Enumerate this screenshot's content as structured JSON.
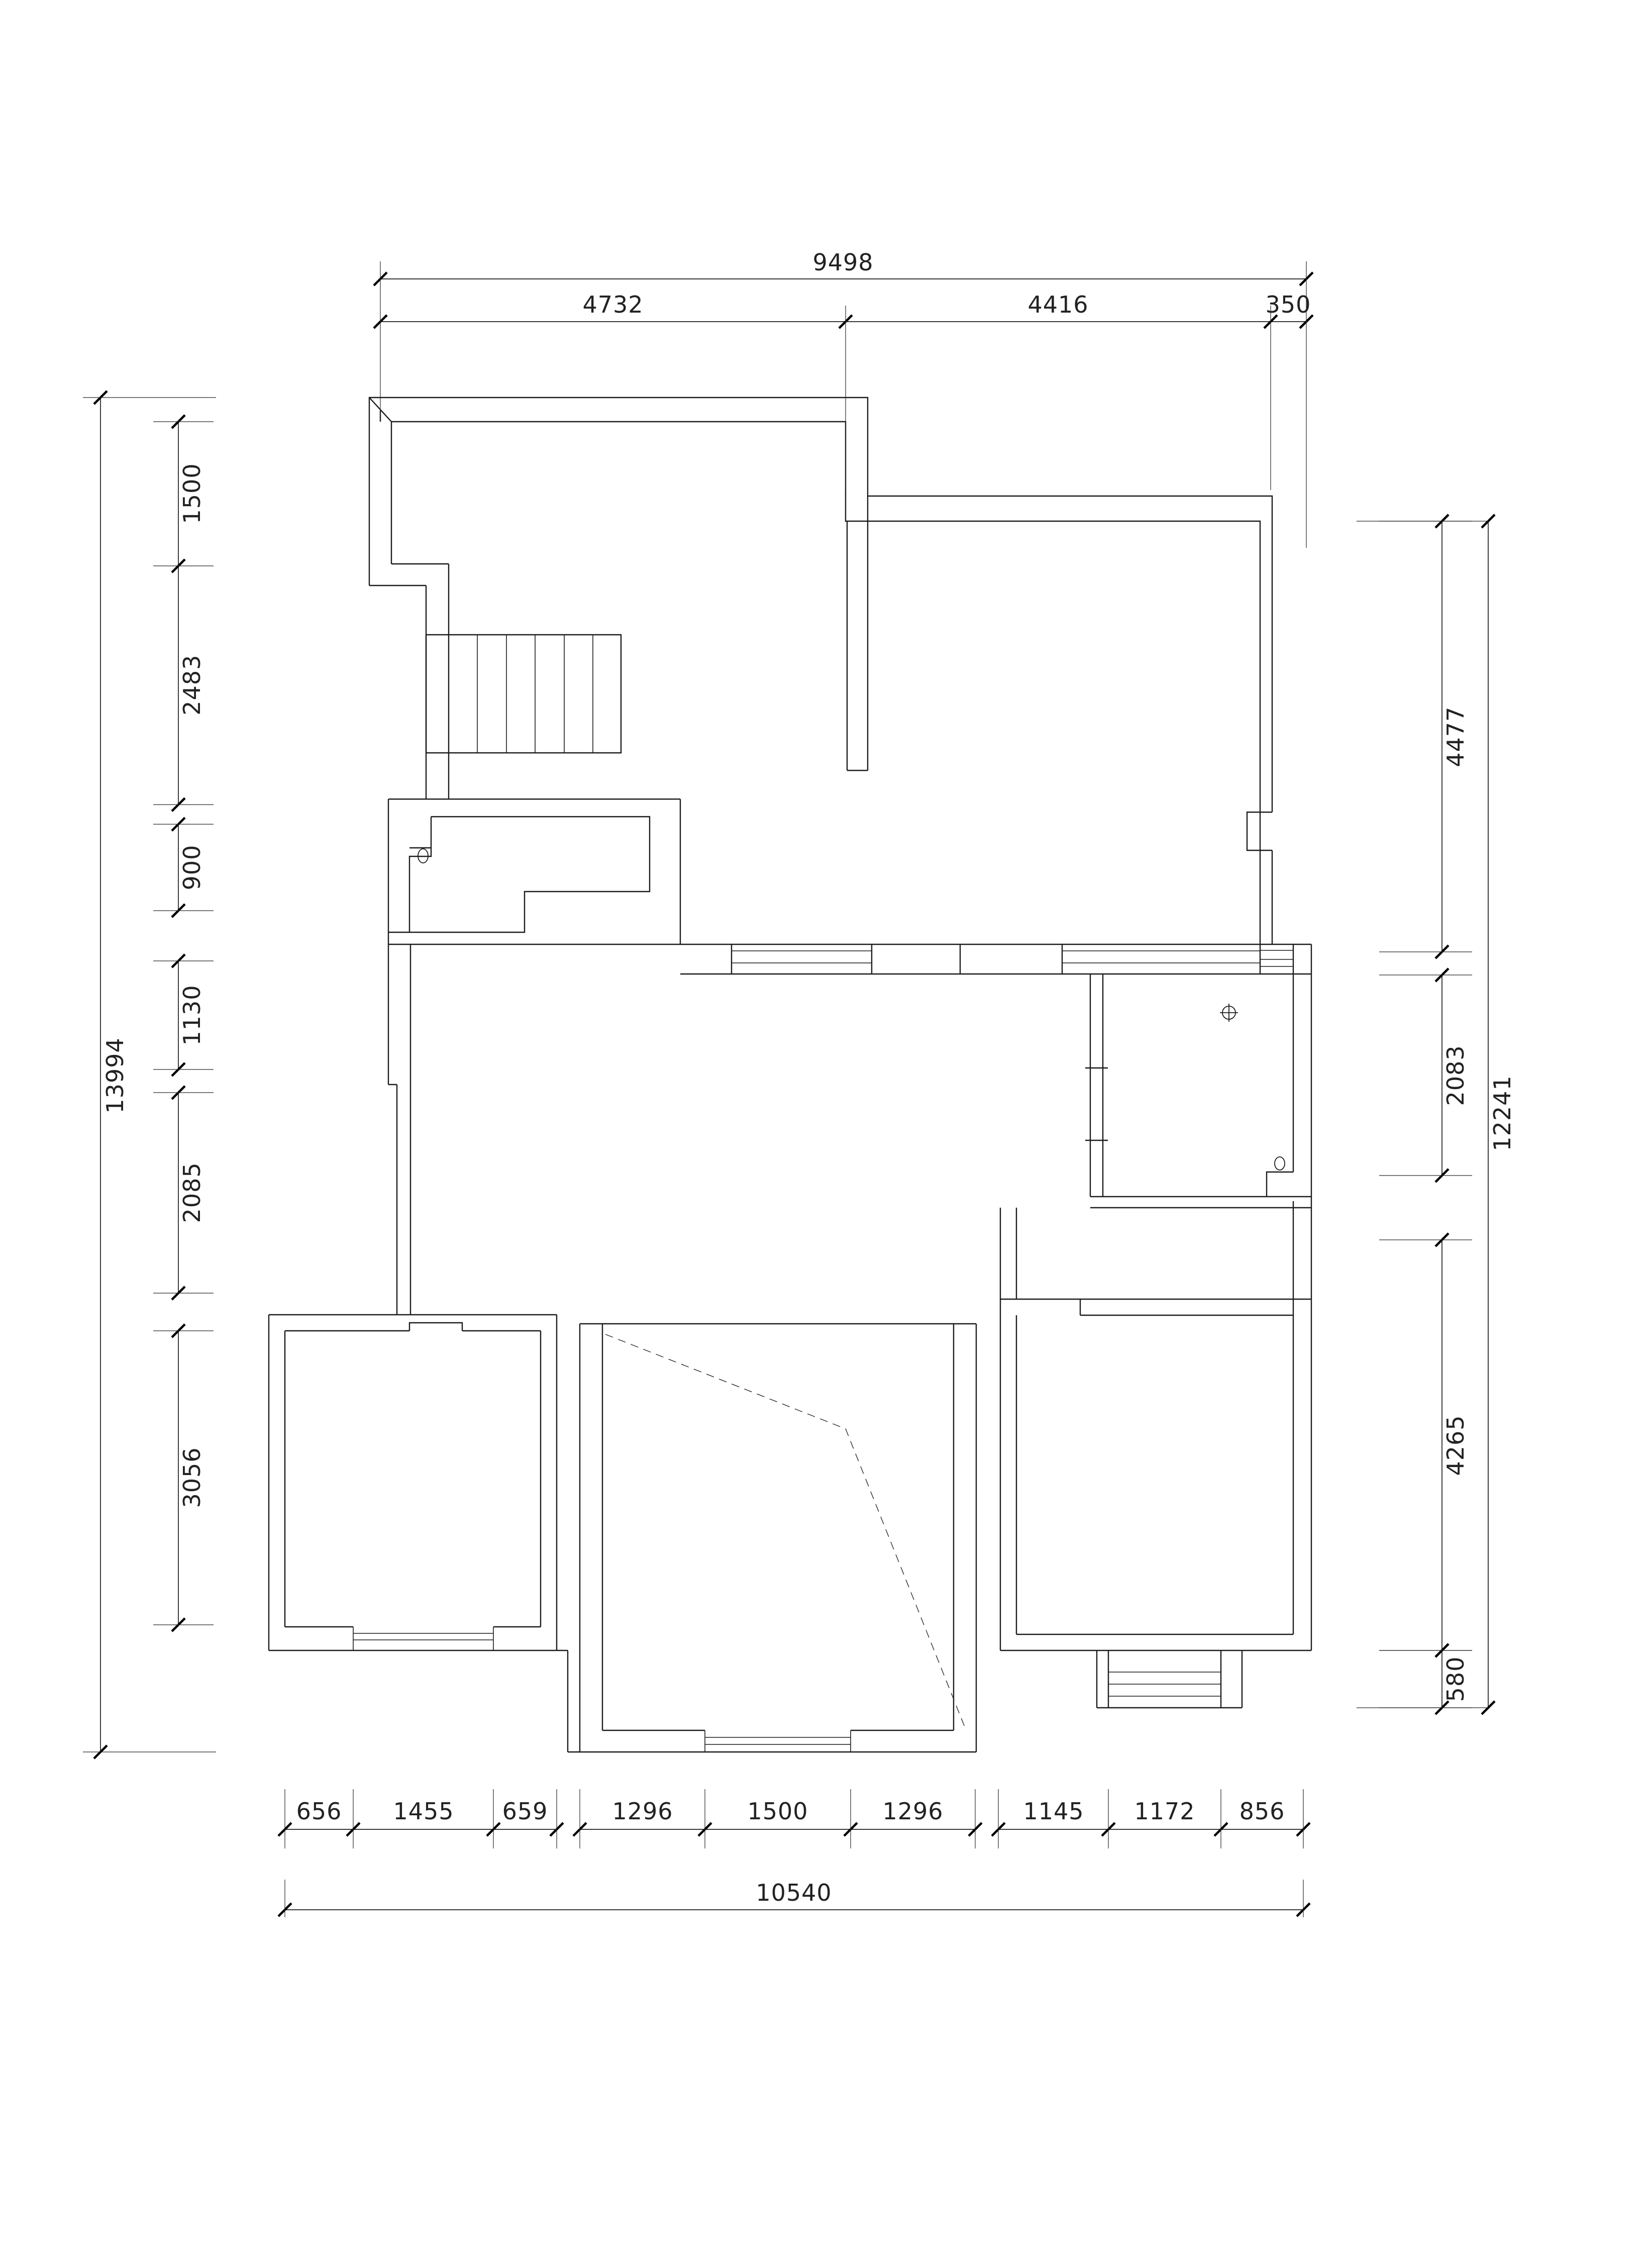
{
  "drawing": {
    "type": "architectural floor plan",
    "units": "mm",
    "line_color": "#1c1c1c",
    "background": "#ffffff",
    "dimensions": {
      "top": {
        "overall": "9498",
        "segments": [
          "4732",
          "4416",
          "350"
        ]
      },
      "left": {
        "overall": "13994",
        "segments": [
          "1500",
          "2483",
          "900",
          "1130",
          "2085",
          "3056"
        ]
      },
      "right": {
        "overall": "12241",
        "segments": [
          "4477",
          "2083",
          "4265",
          "580"
        ]
      },
      "bottom": {
        "overall": "10540",
        "segments": [
          "656",
          "1455",
          "659",
          "1296",
          "1500",
          "1296",
          "1145",
          "1172",
          "856"
        ]
      }
    },
    "features": {
      "stair_treads": 7,
      "symbols": [
        "floor-drain",
        "door-knob",
        "kitchen-fixture"
      ],
      "windows": 5,
      "rooms": [
        "upper-hall",
        "top-right-room",
        "kitchen",
        "living-area",
        "bathroom",
        "bottom-left-room",
        "bottom-middle-room",
        "bottom-right-room"
      ]
    }
  }
}
